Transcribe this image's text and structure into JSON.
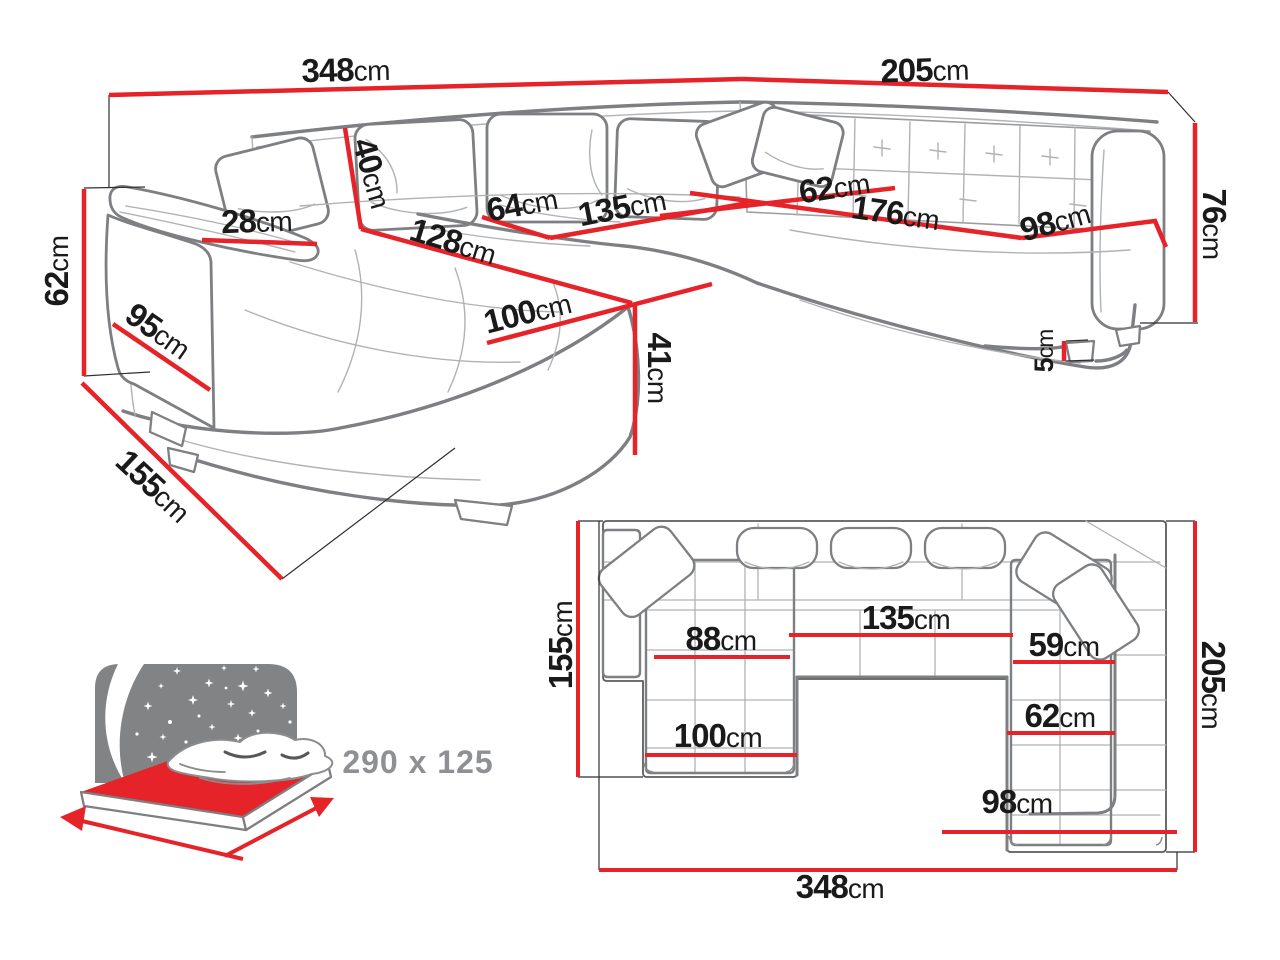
{
  "colors": {
    "dimension_red": "#e62329",
    "sofa_outline_gray": "#7d7f82",
    "seam_gray": "#b0b2b4",
    "label_black": "#1a1a1a",
    "muted_gray_text": "#8e9093",
    "headboard_gray": "#818385"
  },
  "perspective_view": {
    "dims": {
      "total_width": {
        "v": "348",
        "u": "cm"
      },
      "right_width": {
        "v": "205",
        "u": "cm"
      },
      "arm_height": {
        "v": "62",
        "u": "cm"
      },
      "arm_depth": {
        "v": "95",
        "u": "cm"
      },
      "total_depth": {
        "v": "155",
        "u": "cm"
      },
      "armrest_width": {
        "v": "28",
        "u": "cm"
      },
      "back_cushion": {
        "v": "40",
        "u": "cm"
      },
      "chaise_length": {
        "v": "128",
        "u": "cm"
      },
      "chaise_width": {
        "v": "100",
        "u": "cm"
      },
      "seat_depth_mid": {
        "v": "64",
        "u": "cm"
      },
      "mid_seat_width": {
        "v": "135",
        "u": "cm"
      },
      "seat_height": {
        "v": "41",
        "u": "cm"
      },
      "right_seat_depth": {
        "v": "62",
        "u": "cm"
      },
      "right_seat_length": {
        "v": "176",
        "u": "cm"
      },
      "right_end_width": {
        "v": "98",
        "u": "cm"
      },
      "back_height": {
        "v": "76",
        "u": "cm"
      },
      "leg_height": {
        "v": "5",
        "u": "cm"
      }
    }
  },
  "plan_view": {
    "dims": {
      "left_depth": {
        "v": "155",
        "u": "cm"
      },
      "chaise_seat_width": {
        "v": "88",
        "u": "cm"
      },
      "mid_width": {
        "v": "135",
        "u": "cm"
      },
      "right_seat_width": {
        "v": "59",
        "u": "cm"
      },
      "right_seat_width2": {
        "v": "62",
        "u": "cm"
      },
      "chaise_width": {
        "v": "100",
        "u": "cm"
      },
      "right_end_width": {
        "v": "98",
        "u": "cm"
      },
      "right_depth": {
        "v": "205",
        "u": "cm"
      },
      "total_width": {
        "v": "348",
        "u": "cm"
      }
    }
  },
  "sleeping_info": {
    "label": "290 x 125"
  }
}
